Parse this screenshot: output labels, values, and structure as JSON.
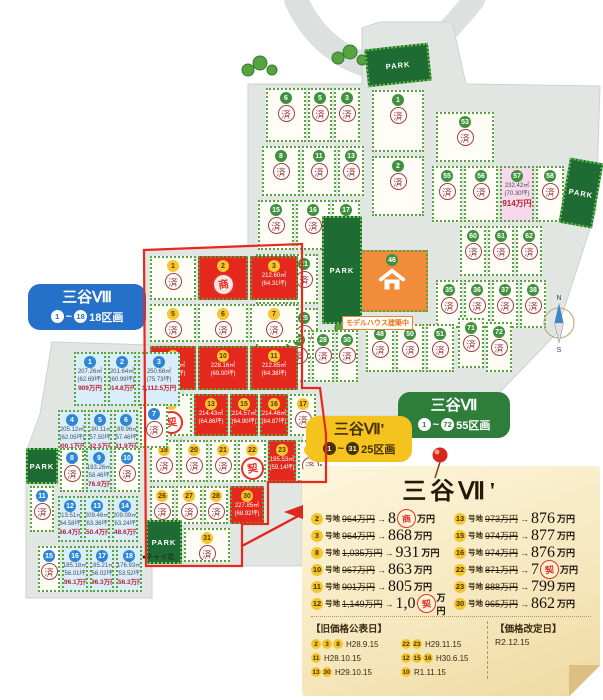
{
  "labels": {
    "sep": "~",
    "m8": {
      "title": "三谷Ⅷ",
      "from": "1",
      "to": "18",
      "count": "18区画"
    },
    "m7": {
      "title": "三谷Ⅶ",
      "from": "1",
      "to": "72",
      "count": "55区画"
    },
    "m7d": {
      "title": "三谷Ⅶ'",
      "from": "1",
      "to": "31",
      "count": "25区画"
    }
  },
  "map": {
    "park_label": "PARK",
    "sold_label": "済",
    "model_house_label": "モデルハウス建築中",
    "flower_label": "●チャイ花",
    "compass_n": "N",
    "compass_s": "S",
    "colors": {
      "available_red": "#e4281d",
      "mitani8_cyan": "#d9eefa",
      "pink_lot": "#f8d9eb",
      "park_green": "#1e6b33"
    }
  },
  "parks": [
    {
      "x": 366,
      "y": 46,
      "w": 64,
      "h": 38,
      "rot": -6
    },
    {
      "x": 322,
      "y": 216,
      "w": 40,
      "h": 108,
      "rot": 0
    },
    {
      "x": 564,
      "y": 160,
      "w": 34,
      "h": 66,
      "rot": 10
    },
    {
      "x": 26,
      "y": 448,
      "w": 32,
      "h": 36,
      "rot": 0
    },
    {
      "x": 146,
      "y": 520,
      "w": 36,
      "h": 44,
      "rot": 0
    }
  ],
  "mitani7_lots": [
    {
      "n": "6",
      "x": 266,
      "y": 88,
      "w": 40,
      "h": 54
    },
    {
      "n": "5",
      "x": 308,
      "y": 88,
      "w": 24,
      "h": 54
    },
    {
      "n": "3",
      "x": 334,
      "y": 88,
      "w": 26,
      "h": 54
    },
    {
      "n": "8",
      "x": 262,
      "y": 146,
      "w": 38,
      "h": 50
    },
    {
      "n": "11",
      "x": 302,
      "y": 146,
      "w": 34,
      "h": 50
    },
    {
      "n": "13",
      "x": 338,
      "y": 146,
      "w": 26,
      "h": 50
    },
    {
      "n": "15",
      "x": 258,
      "y": 200,
      "w": 36,
      "h": 50
    },
    {
      "n": "16",
      "x": 296,
      "y": 200,
      "w": 34,
      "h": 50
    },
    {
      "n": "17",
      "x": 332,
      "y": 200,
      "w": 28,
      "h": 50
    },
    {
      "n": "20",
      "x": 256,
      "y": 254,
      "w": 32,
      "h": 50
    },
    {
      "n": "21",
      "x": 290,
      "y": 254,
      "w": 28,
      "h": 50
    },
    {
      "n": "23",
      "x": 256,
      "y": 308,
      "w": 32,
      "h": 50
    },
    {
      "n": "25",
      "x": 290,
      "y": 308,
      "w": 28,
      "h": 50
    },
    {
      "n": "1",
      "x": 372,
      "y": 90,
      "w": 52,
      "h": 62
    },
    {
      "n": "2",
      "x": 372,
      "y": 156,
      "w": 52,
      "h": 60
    },
    {
      "n": "53",
      "x": 436,
      "y": 112,
      "w": 58,
      "h": 50
    },
    {
      "n": "55",
      "x": 432,
      "y": 166,
      "w": 30,
      "h": 56
    },
    {
      "n": "56",
      "x": 464,
      "y": 166,
      "w": 34,
      "h": 56
    },
    {
      "n": "57",
      "x": 500,
      "y": 166,
      "w": 34,
      "h": 56,
      "t": "pink",
      "lines": [
        "232.42㎡",
        "(70.30坪)",
        "914万円"
      ]
    },
    {
      "n": "58",
      "x": 536,
      "y": 166,
      "w": 28,
      "h": 56
    },
    {
      "n": "60",
      "x": 460,
      "y": 226,
      "w": 26,
      "h": 50
    },
    {
      "n": "61",
      "x": 488,
      "y": 226,
      "w": 26,
      "h": 50
    },
    {
      "n": "62",
      "x": 516,
      "y": 226,
      "w": 26,
      "h": 50
    },
    {
      "n": "35",
      "x": 436,
      "y": 280,
      "w": 26,
      "h": 48
    },
    {
      "n": "36",
      "x": 464,
      "y": 280,
      "w": 26,
      "h": 48
    },
    {
      "n": "37",
      "x": 492,
      "y": 280,
      "w": 26,
      "h": 48
    },
    {
      "n": "38",
      "x": 520,
      "y": 280,
      "w": 26,
      "h": 48
    },
    {
      "n": "46",
      "x": 356,
      "y": 250,
      "w": 72,
      "h": 62,
      "t": "model"
    },
    {
      "n": "27",
      "x": 288,
      "y": 330,
      "w": 22,
      "h": 52
    },
    {
      "n": "28",
      "x": 312,
      "y": 330,
      "w": 22,
      "h": 52
    },
    {
      "n": "30",
      "x": 336,
      "y": 330,
      "w": 22,
      "h": 52
    },
    {
      "n": "48",
      "x": 366,
      "y": 324,
      "w": 28,
      "h": 48
    },
    {
      "n": "50",
      "x": 396,
      "y": 324,
      "w": 28,
      "h": 48
    },
    {
      "n": "51",
      "x": 426,
      "y": 324,
      "w": 28,
      "h": 48
    },
    {
      "n": "71",
      "x": 458,
      "y": 318,
      "w": 26,
      "h": 50
    },
    {
      "n": "72",
      "x": 486,
      "y": 322,
      "w": 26,
      "h": 50
    }
  ],
  "mitani7d_lots": [
    {
      "n": "1",
      "x": 150,
      "y": 256,
      "w": 46,
      "h": 44
    },
    {
      "n": "2",
      "x": 198,
      "y": 256,
      "w": 50,
      "h": 44,
      "t": "red",
      "stamp": "商"
    },
    {
      "n": "3",
      "x": 250,
      "y": 256,
      "w": 48,
      "h": 44,
      "t": "red",
      "lines": [
        "212.60㎡",
        "(64.31坪)"
      ]
    },
    {
      "n": "5",
      "x": 150,
      "y": 304,
      "w": 46,
      "h": 38
    },
    {
      "n": "6",
      "x": 198,
      "y": 304,
      "w": 50,
      "h": 38
    },
    {
      "n": "7",
      "x": 250,
      "y": 304,
      "w": 48,
      "h": 38
    },
    {
      "n": "8",
      "x": 150,
      "y": 346,
      "w": 46,
      "h": 44,
      "t": "red",
      "lines": [
        "227.99㎡",
        "(68.96坪)"
      ]
    },
    {
      "n": "10",
      "x": 198,
      "y": 346,
      "w": 50,
      "h": 44,
      "t": "red",
      "lines": [
        "228.16㎡",
        "(69.00坪)"
      ]
    },
    {
      "n": "11",
      "x": 250,
      "y": 346,
      "w": 48,
      "h": 44,
      "t": "red",
      "lines": [
        "212.85㎡",
        "(64.38坪)"
      ]
    },
    {
      "n": "12",
      "x": 150,
      "y": 394,
      "w": 42,
      "h": 42,
      "stamp": "契"
    },
    {
      "n": "13",
      "x": 194,
      "y": 394,
      "w": 34,
      "h": 42,
      "t": "red",
      "lines": [
        "214.43㎡",
        "(64.86坪)"
      ]
    },
    {
      "n": "15",
      "x": 230,
      "y": 394,
      "w": 28,
      "h": 42,
      "t": "red",
      "lines": [
        "214.57㎡",
        "(64.90坪)"
      ]
    },
    {
      "n": "16",
      "x": 260,
      "y": 394,
      "w": 28,
      "h": 42,
      "t": "red",
      "lines": [
        "214.46㎡",
        "(64.87坪)"
      ]
    },
    {
      "n": "17",
      "x": 290,
      "y": 394,
      "w": 26,
      "h": 42
    },
    {
      "n": "18",
      "x": 150,
      "y": 440,
      "w": 28,
      "h": 42
    },
    {
      "n": "20",
      "x": 180,
      "y": 440,
      "w": 28,
      "h": 42
    },
    {
      "n": "21",
      "x": 210,
      "y": 440,
      "w": 26,
      "h": 42
    },
    {
      "n": "22",
      "x": 238,
      "y": 440,
      "w": 28,
      "h": 42,
      "stamp": "契"
    },
    {
      "n": "23",
      "x": 268,
      "y": 440,
      "w": 28,
      "h": 42,
      "t": "red",
      "lines": [
        "195.53㎡",
        "(59.14坪)"
      ]
    },
    {
      "n": "25",
      "x": 298,
      "y": 440,
      "w": 24,
      "h": 42
    },
    {
      "n": "26",
      "x": 150,
      "y": 486,
      "w": 24,
      "h": 38
    },
    {
      "n": "27",
      "x": 176,
      "y": 486,
      "w": 26,
      "h": 38
    },
    {
      "n": "28",
      "x": 204,
      "y": 486,
      "w": 24,
      "h": 38
    },
    {
      "n": "30",
      "x": 230,
      "y": 486,
      "w": 34,
      "h": 38,
      "t": "red",
      "lines": [
        "227.85㎡",
        "(68.92坪)"
      ]
    },
    {
      "n": "31",
      "x": 184,
      "y": 528,
      "w": 46,
      "h": 34
    }
  ],
  "mitani8_lots": [
    {
      "n": "1",
      "x": 74,
      "y": 352,
      "w": 32,
      "h": 54,
      "t": "cyan",
      "lines": [
        "207.26㎡",
        "(62.69坪)",
        "909万円"
      ]
    },
    {
      "n": "2",
      "x": 108,
      "y": 352,
      "w": 28,
      "h": 54,
      "t": "cyan",
      "lines": [
        "201.64㎡",
        "(60.99坪)",
        "914.8万円"
      ]
    },
    {
      "n": "3",
      "x": 138,
      "y": 352,
      "w": 42,
      "h": 54,
      "t": "cyan",
      "lines": [
        "250.68㎡",
        "(75.73坪)",
        "1,112.5万円"
      ]
    },
    {
      "n": "4",
      "x": 58,
      "y": 410,
      "w": 28,
      "h": 50,
      "t": "cyan",
      "lines": [
        "205.12㎡",
        "(62.05坪)",
        "900.1万円"
      ]
    },
    {
      "n": "5",
      "x": 88,
      "y": 410,
      "w": 24,
      "h": 50,
      "t": "cyan",
      "lines": [
        "190.11㎡",
        "(57.50坪)",
        "862.5万円"
      ]
    },
    {
      "n": "6",
      "x": 114,
      "y": 410,
      "w": 24,
      "h": 50,
      "t": "cyan",
      "lines": [
        "189.96㎡",
        "(57.46坪)",
        "861.9万円"
      ]
    },
    {
      "n": "7",
      "x": 140,
      "y": 404,
      "w": 28,
      "h": 44
    },
    {
      "n": "8",
      "x": 60,
      "y": 448,
      "w": 24,
      "h": 44
    },
    {
      "n": "9",
      "x": 86,
      "y": 448,
      "w": 26,
      "h": 44,
      "t": "cyan",
      "lines": [
        "193.26㎡",
        "(58.46坪)",
        "876.9万円"
      ]
    },
    {
      "n": "10",
      "x": 114,
      "y": 448,
      "w": 26,
      "h": 44
    },
    {
      "n": "11",
      "x": 30,
      "y": 486,
      "w": 24,
      "h": 46
    },
    {
      "n": "12",
      "x": 58,
      "y": 496,
      "w": 24,
      "h": 46,
      "t": "cyan",
      "lines": [
        "213.51㎡",
        "(64.58坪)",
        "966.4万円"
      ]
    },
    {
      "n": "13",
      "x": 84,
      "y": 496,
      "w": 26,
      "h": 46,
      "t": "cyan",
      "lines": [
        "209.46㎡",
        "(63.36坪)",
        "950.4万円"
      ]
    },
    {
      "n": "14",
      "x": 112,
      "y": 496,
      "w": 26,
      "h": 46,
      "t": "cyan",
      "lines": [
        "209.09㎡",
        "(63.24坪)",
        "948.6万円"
      ]
    },
    {
      "n": "15",
      "x": 38,
      "y": 546,
      "w": 22,
      "h": 46
    },
    {
      "n": "16",
      "x": 62,
      "y": 546,
      "w": 26,
      "h": 46,
      "t": "cyan",
      "lines": [
        "185.18㎡",
        "(56.01坪)",
        "896.1万円"
      ]
    },
    {
      "n": "17",
      "x": 90,
      "y": 546,
      "w": 24,
      "h": 46,
      "t": "cyan",
      "lines": [
        "185.21㎡",
        "(56.02坪)",
        "896.3万円"
      ]
    },
    {
      "n": "18",
      "x": 116,
      "y": 546,
      "w": 26,
      "h": 46,
      "t": "cyan",
      "lines": [
        "176.93㎡",
        "(53.52坪)",
        "856.3万円"
      ]
    }
  ],
  "note": {
    "title": "三谷Ⅶ'",
    "unit_suffix": "号地",
    "rows_left": [
      {
        "no": "2",
        "old": "964万円",
        "new": "8",
        "stamp": "商",
        "tail": "万円"
      },
      {
        "no": "3",
        "old": "964万円",
        "new": "868",
        "tail": "万円"
      },
      {
        "no": "8",
        "old": "1,035万円",
        "new": "931",
        "tail": "万円"
      },
      {
        "no": "10",
        "old": "967万円",
        "new": "863",
        "tail": "万円"
      },
      {
        "no": "11",
        "old": "901万円",
        "new": "805",
        "tail": "万円"
      },
      {
        "no": "12",
        "old": "1,149万円",
        "new": "1,0",
        "stamp": "契",
        "tail": "万円"
      }
    ],
    "rows_right": [
      {
        "no": "13",
        "old": "973万円",
        "new": "876",
        "tail": "万円"
      },
      {
        "no": "15",
        "old": "974万円",
        "new": "877",
        "tail": "万円"
      },
      {
        "no": "16",
        "old": "974万円",
        "new": "876",
        "tail": "万円"
      },
      {
        "no": "22",
        "old": "871万円",
        "new": "7",
        "stamp": "契",
        "tail": "万円"
      },
      {
        "no": "23",
        "old": "888万円",
        "new": "799",
        "tail": "万円"
      },
      {
        "no": "30",
        "old": "965万円",
        "new": "862",
        "tail": "万円"
      }
    ],
    "arrow": "→",
    "pub_label": "【旧価格公表日】",
    "pub_col1": [
      {
        "badges": [
          "2",
          "3",
          "8"
        ],
        "date": "H28.9.15"
      },
      {
        "badges": [
          "11"
        ],
        "date": "H28.10.15"
      },
      {
        "badges": [
          "13",
          "30"
        ],
        "date": "H29.10.15"
      }
    ],
    "pub_col2": [
      {
        "badges": [
          "22",
          "23"
        ],
        "date": "H29.11.15"
      },
      {
        "badges": [
          "12",
          "15",
          "16"
        ],
        "date": "H30.6.15"
      },
      {
        "badges": [
          "10"
        ],
        "date": "R1.11.15"
      }
    ],
    "rev_label": "【価格改定日】",
    "rev_date": "R2.12.15"
  }
}
